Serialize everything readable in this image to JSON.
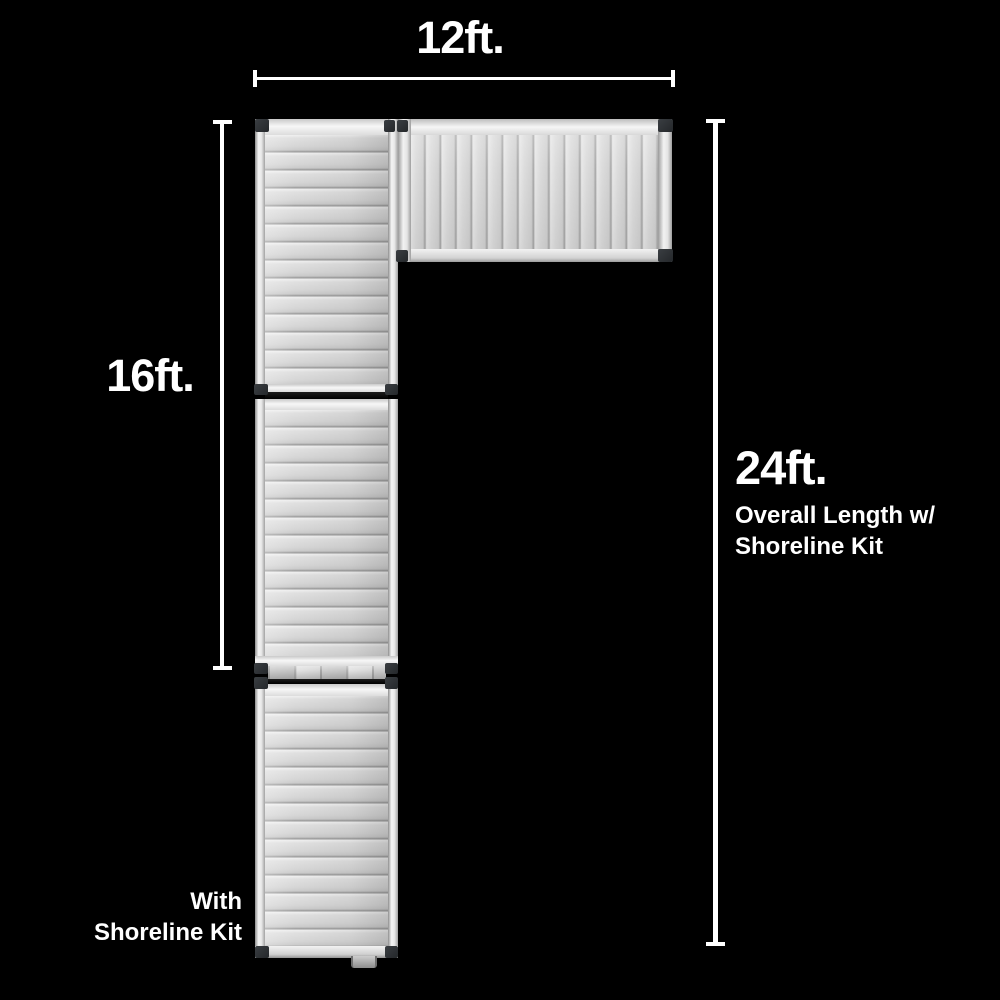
{
  "scene": {
    "type": "product-dimension-diagram",
    "subject": "aluminum-dock-with-shoreline-kit",
    "background_color": "#000000",
    "text_color": "#ffffff"
  },
  "dimensions": {
    "width_top": {
      "label": "12ft."
    },
    "dock_length": {
      "label": "16ft."
    },
    "overall_length": {
      "label": "24ft.",
      "caption_line1": "Overall Length w/",
      "caption_line2": "Shoreline Kit"
    }
  },
  "labels": {
    "shoreline_kit": {
      "line1": "With",
      "line2": "Shoreline Kit"
    }
  },
  "dock": {
    "colors": {
      "deck": "#d6d6d6",
      "rail_highlight": "#f4f4f4",
      "plank_seam": "#979797",
      "corner_bracket": "#2b2e31"
    }
  }
}
